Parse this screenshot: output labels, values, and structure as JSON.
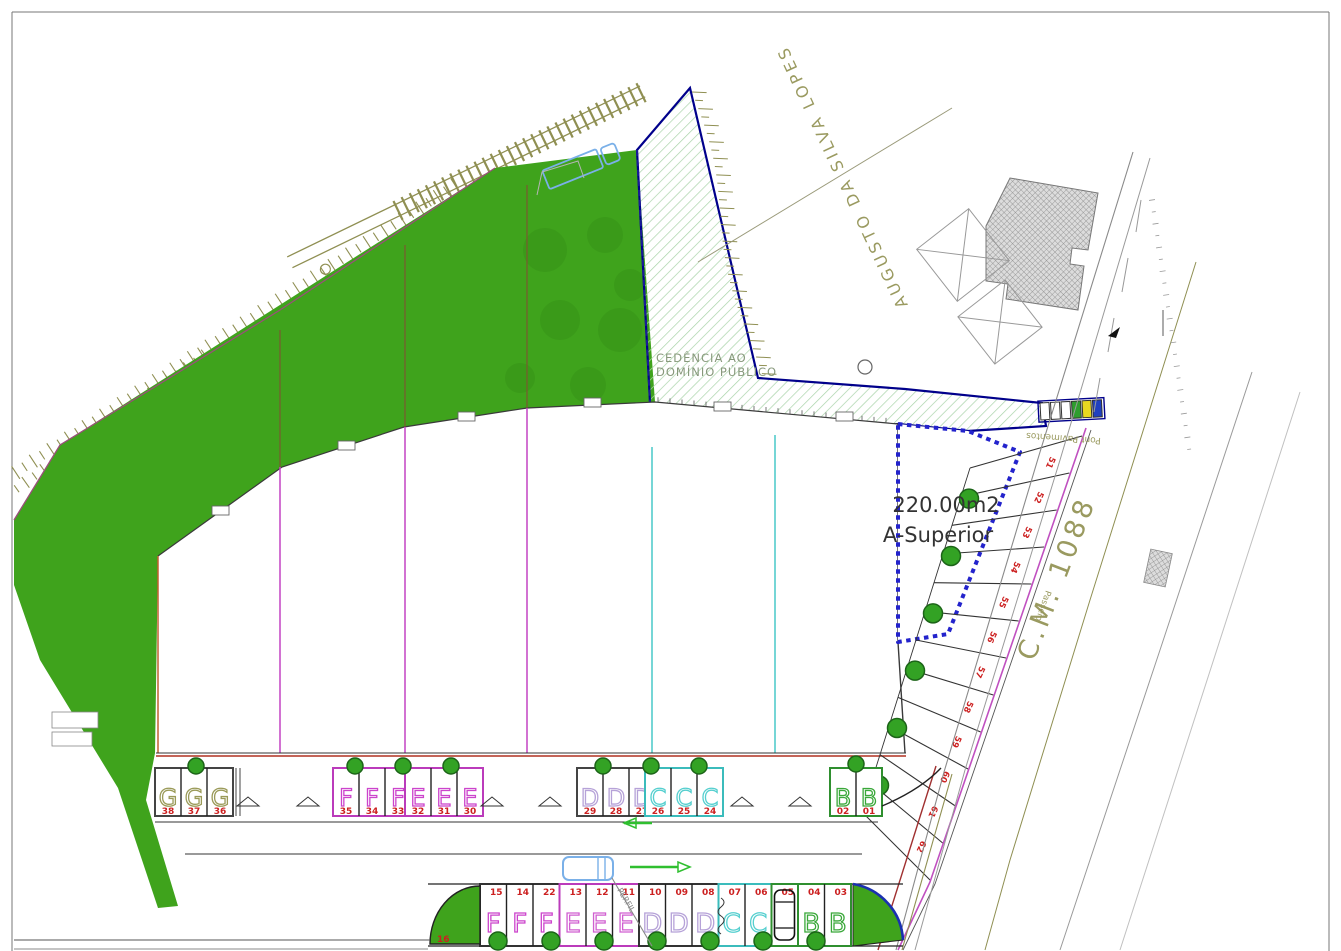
{
  "plan": {
    "street_label": "AUGUSTO DA SILVA LOPES",
    "cedencia_line1": "CEDÊNCIA AO",
    "cedencia_line2": "DOMÍNIO PÚBLICO",
    "parcel_area": "220.00m2",
    "parcel_class": "A-Superior",
    "road_label": "C.M. 1088",
    "road_note_top": "Pont Pavimentos",
    "road_note_mid": "Passeio",
    "section_note": "PERFIL",
    "corner_stall": "16",
    "number_color": "#cc2020",
    "top_row_groups": [
      {
        "letter": "G",
        "color": "#9a9a58",
        "border": "#444444",
        "stalls": [
          "38",
          "37",
          "36"
        ]
      },
      {
        "letter": "F",
        "color": "#cc44cc",
        "border": "#bb3bbb",
        "stalls": [
          "35",
          "34",
          "33"
        ]
      },
      {
        "letter": "E",
        "color": "#cc44cc",
        "border": "#bb3bbb",
        "stalls": [
          "32",
          "31",
          "30"
        ]
      },
      {
        "letter": "D",
        "color": "#b6a2d8",
        "border": "#444444",
        "stalls": [
          "29",
          "28",
          "27"
        ]
      },
      {
        "letter": "C",
        "color": "#55cfcf",
        "border": "#3bbcbc",
        "stalls": [
          "26",
          "25",
          "24"
        ]
      },
      {
        "letter": "B",
        "color": "#3aa83a",
        "border": "#2f8f2f",
        "stalls": [
          "02",
          "01"
        ]
      }
    ],
    "bottom_row_groups": [
      {
        "letter": "F",
        "color": "#cc44cc",
        "border": "#333333",
        "stalls": [
          "15",
          "14",
          "22"
        ]
      },
      {
        "letter": "E",
        "color": "#d05fd0",
        "border": "#bb3bbb",
        "stalls": [
          "13",
          "12",
          "11"
        ]
      },
      {
        "letter": "D",
        "color": "#b6a2d8",
        "border": "#333333",
        "stalls": [
          "10",
          "09",
          "08"
        ]
      },
      {
        "letter": "C",
        "color": "#55cfcf",
        "border": "#3bbcbc",
        "stalls": [
          "07",
          "06"
        ]
      },
      {
        "letter": "C",
        "color": "#55cfcf",
        "border": "#2f8f2f",
        "stalls": [
          "05"
        ],
        "car": true
      },
      {
        "letter": "B",
        "color": "#3aa83a",
        "border": "#2f8f2f",
        "stalls": [
          "04",
          "03"
        ]
      }
    ],
    "right_stall_numbers": [
      "51",
      "52",
      "53",
      "54",
      "55",
      "56",
      "57",
      "58",
      "59",
      "60",
      "61",
      "62"
    ],
    "ecoponto_bins": [
      "white",
      "white",
      "white",
      "green",
      "yellow",
      "blue"
    ],
    "colors": {
      "green": "#3fa31c",
      "tree": "#33a224",
      "tree_edge": "#1c6418",
      "hatch": "#a9d3a9",
      "blue_border": "#00008b",
      "dotted_blue": "#2323cc",
      "magenta": "#c343c3",
      "cyan": "#49c9c9",
      "olive": "#8f8f52",
      "maroon": "#b03020",
      "car_blue": "#7ab0e8",
      "arrow_green": "#2fbf2f"
    }
  }
}
